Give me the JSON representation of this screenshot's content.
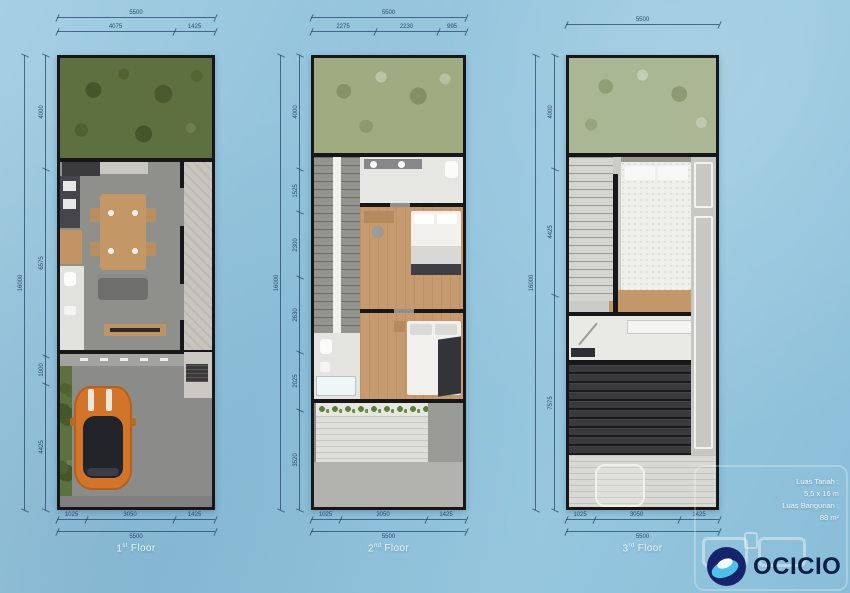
{
  "title": "house-floor-plans",
  "plans": [
    {
      "id": "first-floor",
      "floor_label": {
        "num": "1",
        "sup": "st",
        "word": "Floor"
      },
      "dims": {
        "top_total": "5500",
        "top_segments": [
          "4075",
          "1425"
        ],
        "left_total": "16000",
        "left_segments": [
          "4000",
          "6575",
          "1000",
          "4425"
        ],
        "bottom_segments": [
          "1025",
          "3050",
          "1425"
        ],
        "bottom_total": "5500"
      }
    },
    {
      "id": "second-floor",
      "floor_label": {
        "num": "2",
        "sup": "nd",
        "word": "Floor"
      },
      "dims": {
        "top_total": "5500",
        "top_segments": [
          "2275",
          "2230",
          "995"
        ],
        "left_total": "16000",
        "left_segments": [
          "4000",
          "1525",
          "2300",
          "2630",
          "2025",
          "3520"
        ],
        "bottom_segments": [
          "1025",
          "3050",
          "1425"
        ],
        "bottom_total": "5500"
      }
    },
    {
      "id": "third-floor",
      "floor_label": {
        "num": "3",
        "sup": "rd",
        "word": "Floor"
      },
      "dims": {
        "top_total": "5500",
        "top_segments": [],
        "left_total": "16000",
        "left_segments": [
          "4000",
          "4425",
          "7575"
        ],
        "bottom_segments": [
          "1025",
          "3050",
          "1425"
        ],
        "bottom_total": "5500"
      }
    }
  ],
  "info": {
    "line1": "Luas Tanah :",
    "line2": "5,5 x 16 m",
    "line3": "Luas Bangunan :",
    "line4": "88 m²"
  },
  "logo": {
    "text": "OCICIO",
    "icon": "ocicio-globe-icon"
  },
  "colors": {
    "background_blue": "#8fc2dc",
    "logo_navy": "#15246b",
    "logo_light_blue": "#4fc0e8",
    "car_orange": "#d2752b",
    "garden_green": "#5f7040",
    "wood_floor": "#c59a6e",
    "dimension_lines": "#29496c"
  }
}
